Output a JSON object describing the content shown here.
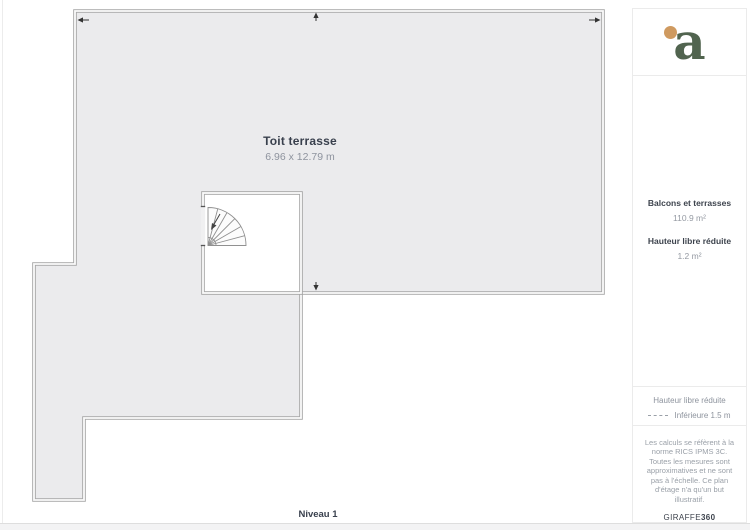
{
  "plan": {
    "room": {
      "name": "Toit terrasse",
      "dimensions": "6.96 x 12.79 m"
    },
    "level_label": "Niveau 1",
    "colors": {
      "floor_fill": "#ebebed",
      "wall": "#a6a6a6",
      "wall_gap": "#fbfbfb",
      "jamb": "#555555",
      "stair_line": "#909090",
      "arrow": "#333333"
    }
  },
  "sidebar": {
    "logo": {
      "letter": "a",
      "green": "#51644f",
      "orange": "#cf9a60"
    },
    "measurements": [
      {
        "label": "Balcons et terrasses",
        "value": "110.9 m²"
      },
      {
        "label": "Hauteur libre réduite",
        "value": "1.2 m²"
      }
    ],
    "legend": {
      "title": "Hauteur libre réduite",
      "item": "Inférieure 1.5 m"
    },
    "disclaimer": "Les calculs se réfèrent à la norme RICS IPMS 3C. Toutes les mesures sont approximatives et ne sont pas à l'échelle. Ce plan d'étage n'a qu'un but illustratif.",
    "brand": {
      "name": "GIRAFFE",
      "suffix": "360"
    }
  }
}
